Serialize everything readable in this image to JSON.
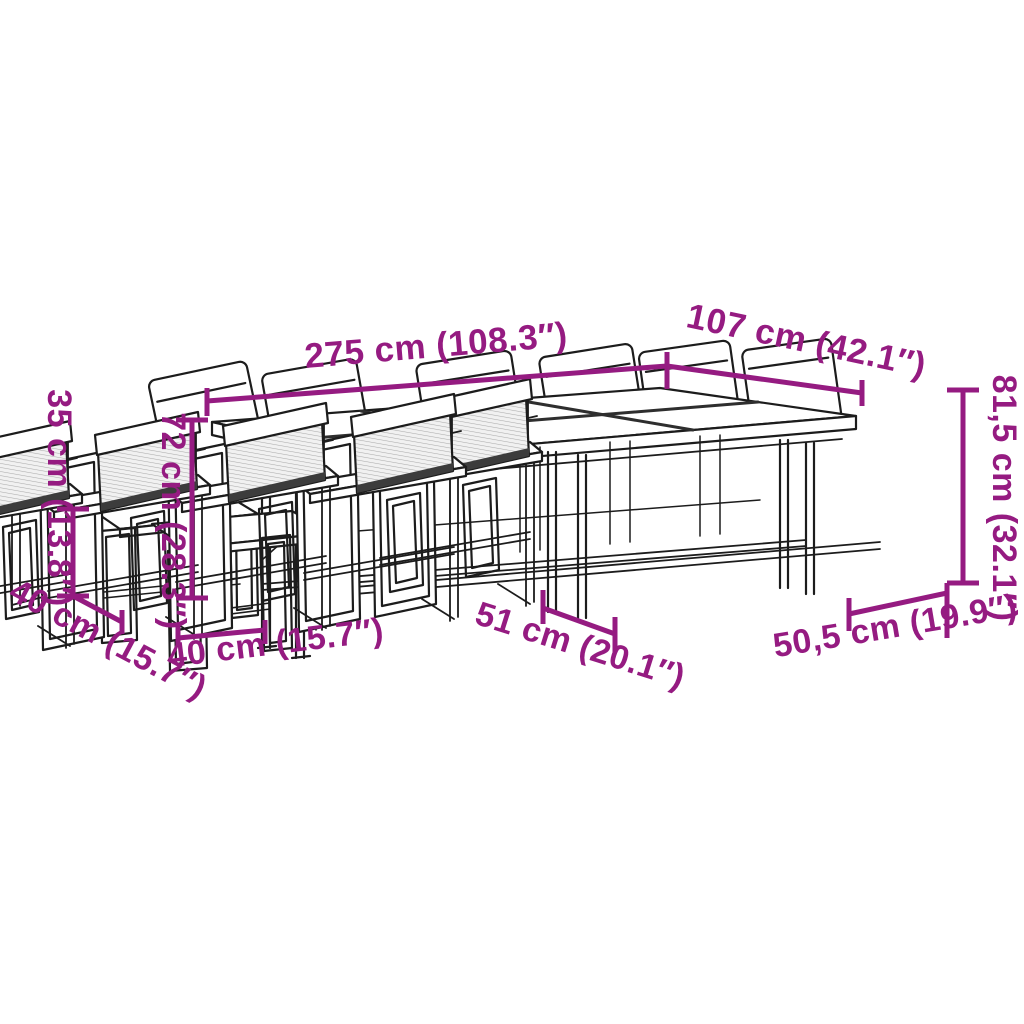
{
  "palette": {
    "background": "#ffffff",
    "line_color": "#1c1c1c",
    "dimension_color": "#951b81",
    "mesh_fill": "#f1f1f1",
    "mesh_hatch": "#ababab",
    "shadow_strip": "#3c3c3c"
  },
  "diagram": {
    "type": "product-dimension-line-drawing",
    "subject": "outdoor dining set: long table, textilene chairs and nesting stools",
    "labels": {
      "table_length": "275 cm (108.3″)",
      "table_depth": "107 cm (42.1″)",
      "chair_height": "81,5 cm (32.1″)",
      "chair_width": "50,5 cm (19.9″)",
      "chair_seat_depth": "51 cm (20.1″)",
      "table_height": "72 cm (28.3″)",
      "stool_height": "35 cm (13.8″)",
      "stool_depth": "40 cm (15.7″)",
      "stool_width": "40 cm (15.7″)"
    }
  }
}
